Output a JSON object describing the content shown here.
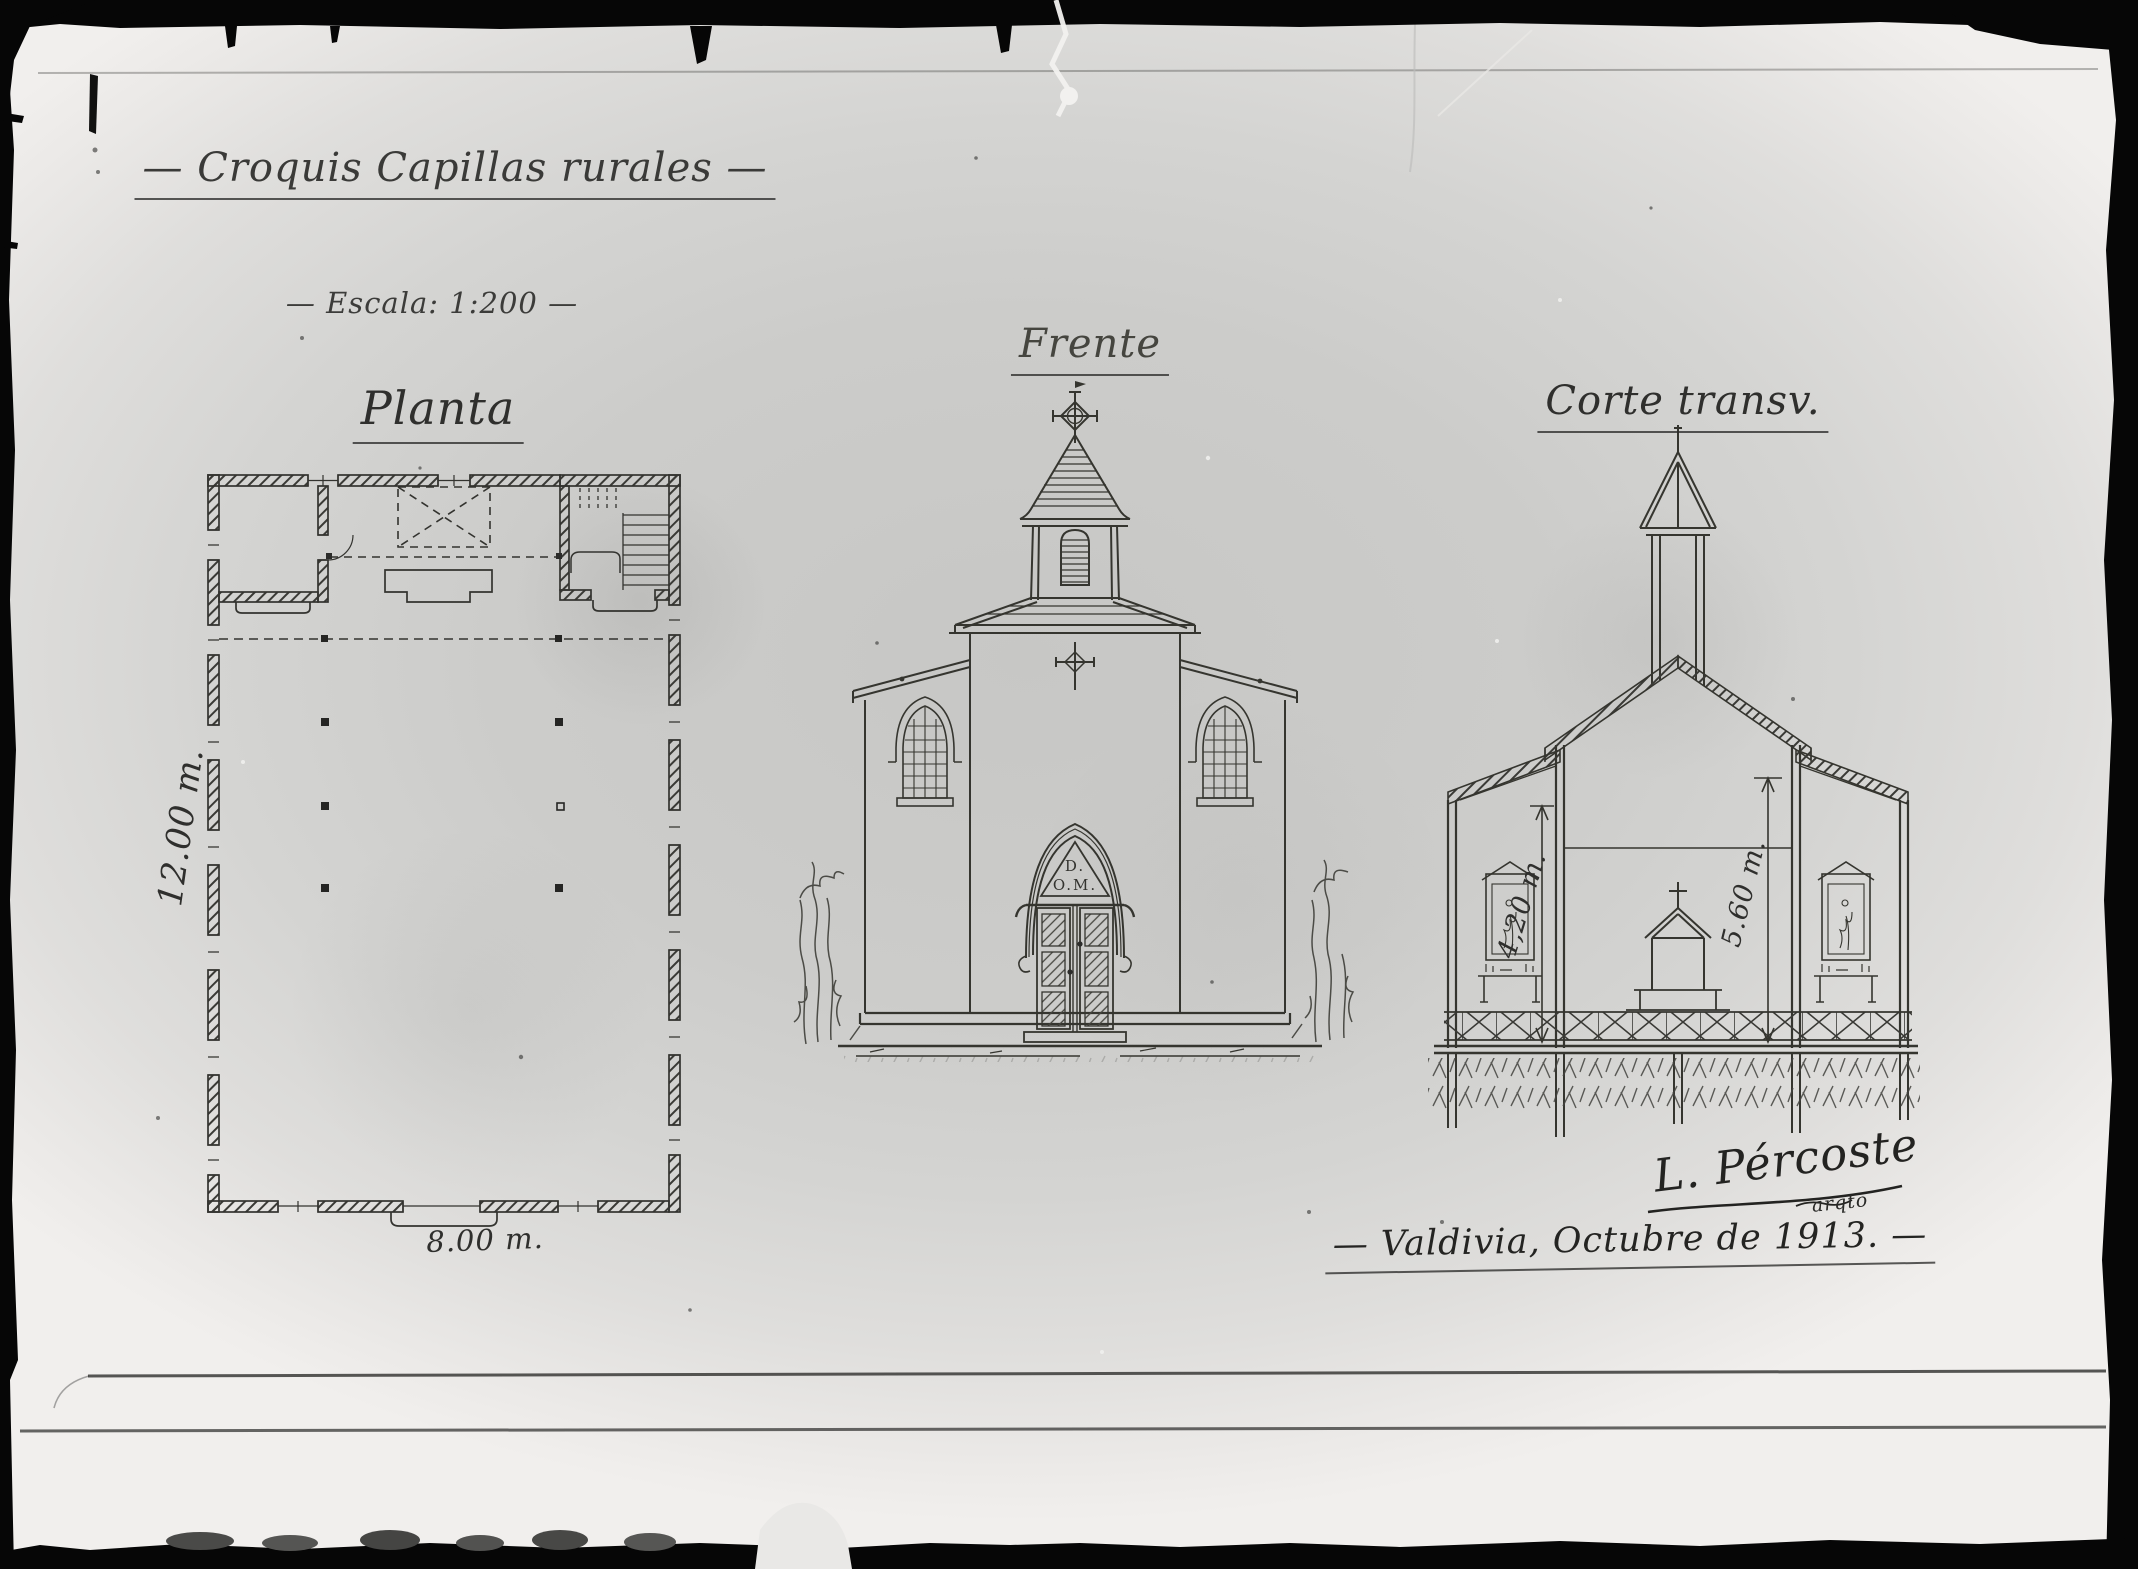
{
  "sheet": {
    "title": "— Croquis Capillas rurales —",
    "scale": "— Escala: 1:200 —"
  },
  "plan": {
    "label": "Planta",
    "height_dimension": "12.00 m.",
    "width_dimension": "8.00 m."
  },
  "front_elevation": {
    "label": "Frente",
    "pediment_inscription_line1": "D.",
    "pediment_inscription_line2": "O.M."
  },
  "cross_section": {
    "label": "Corte transv.",
    "aisle_height_dimension": "4,20 m.",
    "nave_height_dimension": "5.60 m."
  },
  "signature": {
    "name": "L. Pércoste",
    "title_abbrev": "arqto"
  },
  "colophon": {
    "place_date": "— Valdivia, Octubre de 1913. —"
  },
  "ink_color": "#33332f",
  "paper_tone": "#d2d1cf"
}
